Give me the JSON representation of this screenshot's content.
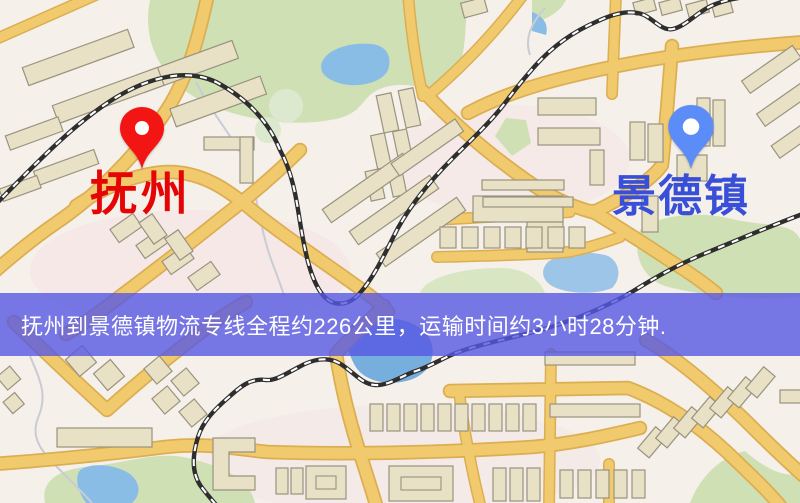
{
  "map": {
    "type": "road-map",
    "banner": {
      "text": "抚州到景德镇物流专线全程约226公里，运输时间约3小时28分钟.",
      "background_color": "#5658e4",
      "text_color": "#ffffff"
    },
    "markers": [
      {
        "id": "origin",
        "label": "抚州",
        "pin_color": "#f31414",
        "label_color": "#e60505",
        "pin_icon": "red-map-pin"
      },
      {
        "id": "destination",
        "label": "景德镇",
        "pin_color": "#5b8cf8",
        "label_color": "#3a4fd8",
        "pin_icon": "blue-map-pin"
      }
    ],
    "route": {
      "origin": "抚州",
      "destination": "景德镇",
      "service": "物流专线",
      "distance_text": "约226公里",
      "duration_text": "约3小时28分钟"
    },
    "palette": {
      "background": "#f5f0ea",
      "road": "#f2ca6e",
      "road_casing": "#dcae52",
      "building_fill": "#e9e1c6",
      "building_stroke": "#99937f",
      "green_area": "#cfe0b5",
      "water": "#84b9e4",
      "railway": "#2e2e2e"
    }
  }
}
